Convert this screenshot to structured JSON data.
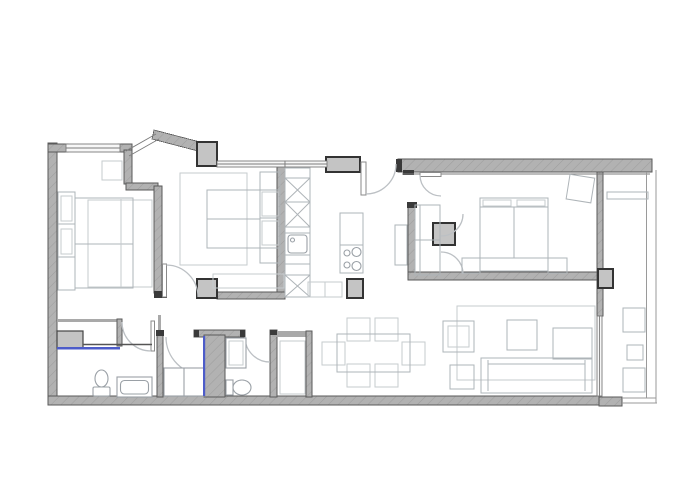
{
  "meta": {
    "aria_label": "Apartment floor plan drawing, top-down architectural view"
  },
  "colors": {
    "bg": "#ffffff",
    "wall": "#b2b2b2",
    "wallHatch": "#9e9e9e",
    "wallStroke": "#5a5a5a",
    "wallThin": "#a9a9a9",
    "pierFill": "#c4c4c4",
    "pierStroke": "#333333",
    "cap": "#3a3a3a",
    "windowFill": "#f7f7f7",
    "windowStroke": "#7b7b7b",
    "rail": "#9a9a9a",
    "furniture": "#c6cbce",
    "furnitureDark": "#aeb4b8",
    "fixture": "#9aa0a6",
    "door": "#bcc0c4",
    "leaf": "#8a8a8a",
    "accentBlue": "#4d5cc9"
  },
  "rooms": [
    {
      "name": "bedroom-1",
      "fixtures": [
        "double-bed",
        "headboard",
        "rug",
        "wall-shelf"
      ]
    },
    {
      "name": "bedroom-2",
      "fixtures": [
        "double-bed",
        "headboard",
        "rug",
        "bench"
      ]
    },
    {
      "name": "kitchen",
      "fixtures": [
        "tall-unit-column",
        "sink",
        "cooktop",
        "stools"
      ]
    },
    {
      "name": "master-bedroom",
      "fixtures": [
        "double-bed",
        "nightstands",
        "closet",
        "tilted-chair"
      ]
    },
    {
      "name": "bathroom-1",
      "fixtures": [
        "vanity",
        "toilet",
        "bathtub"
      ]
    },
    {
      "name": "shower-room",
      "fixtures": [
        "shower-tray",
        "glass-screen"
      ]
    },
    {
      "name": "wc",
      "fixtures": [
        "washbasin",
        "toilet"
      ]
    },
    {
      "name": "dining-area",
      "fixtures": [
        "table",
        "six-chairs"
      ]
    },
    {
      "name": "living-area",
      "fixtures": [
        "sofa",
        "chaise",
        "coffee-table",
        "armchair",
        "side-table",
        "rug"
      ]
    },
    {
      "name": "balcony",
      "fixtures": [
        "bench",
        "planters",
        "railing"
      ]
    }
  ]
}
